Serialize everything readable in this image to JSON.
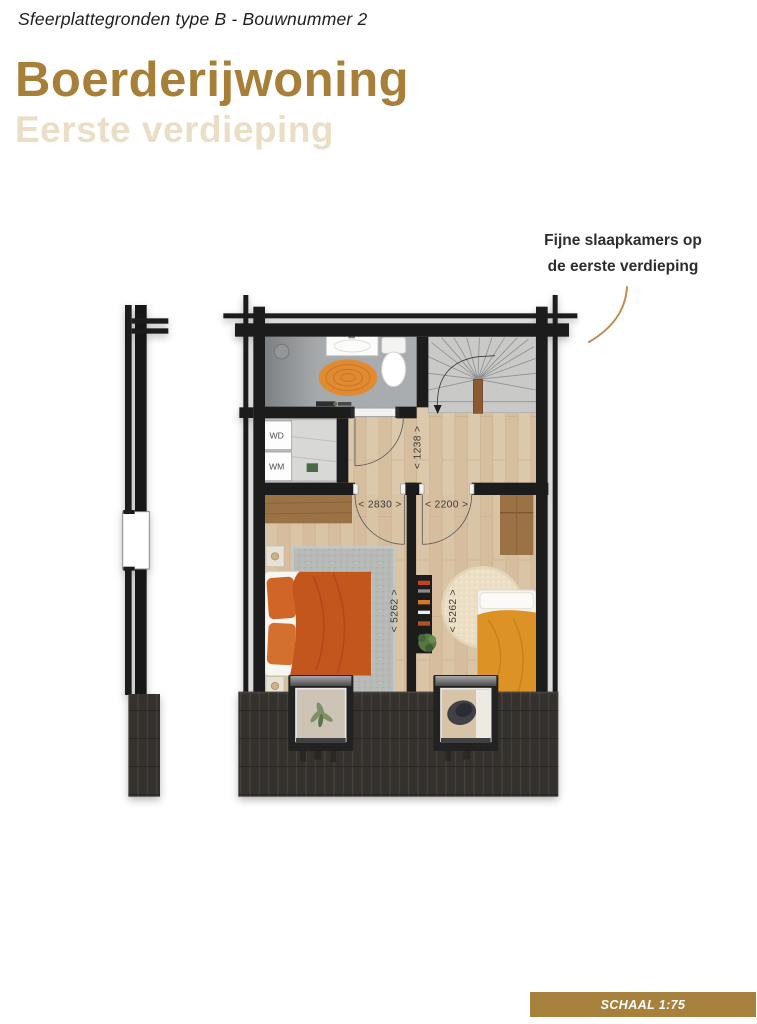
{
  "header": {
    "eyebrow": "Sfeerplattegronden type B - Bouwnummer 2",
    "title": "Boerderijwoning",
    "subtitle": "Eerste verdieping"
  },
  "annotation": {
    "line1": "Fijne slaapkamers op",
    "line2": "de eerste verdieping"
  },
  "plan": {
    "labels": {
      "wd": "WD",
      "wm": "WM"
    },
    "dimensions": {
      "hall_depth": "< 1238 >",
      "bedroom1_width": "< 2830 >",
      "bedroom2_width": "< 2200 >",
      "bedroom1_depth": "< 5262 >",
      "bedroom2_depth": "< 5262 >"
    }
  },
  "footer": {
    "scale": "SCHAAL 1:75"
  },
  "colors": {
    "accent_brown": "#a87f39",
    "accent_light": "#ebdec6",
    "badge_brown": "#a7803b",
    "leader_line": "#c28b52",
    "wall_black": "#1d1d1d",
    "bed_orange": "#c2561f",
    "rug_orange": "#e08a33",
    "duvet_orange": "#dd9226"
  }
}
